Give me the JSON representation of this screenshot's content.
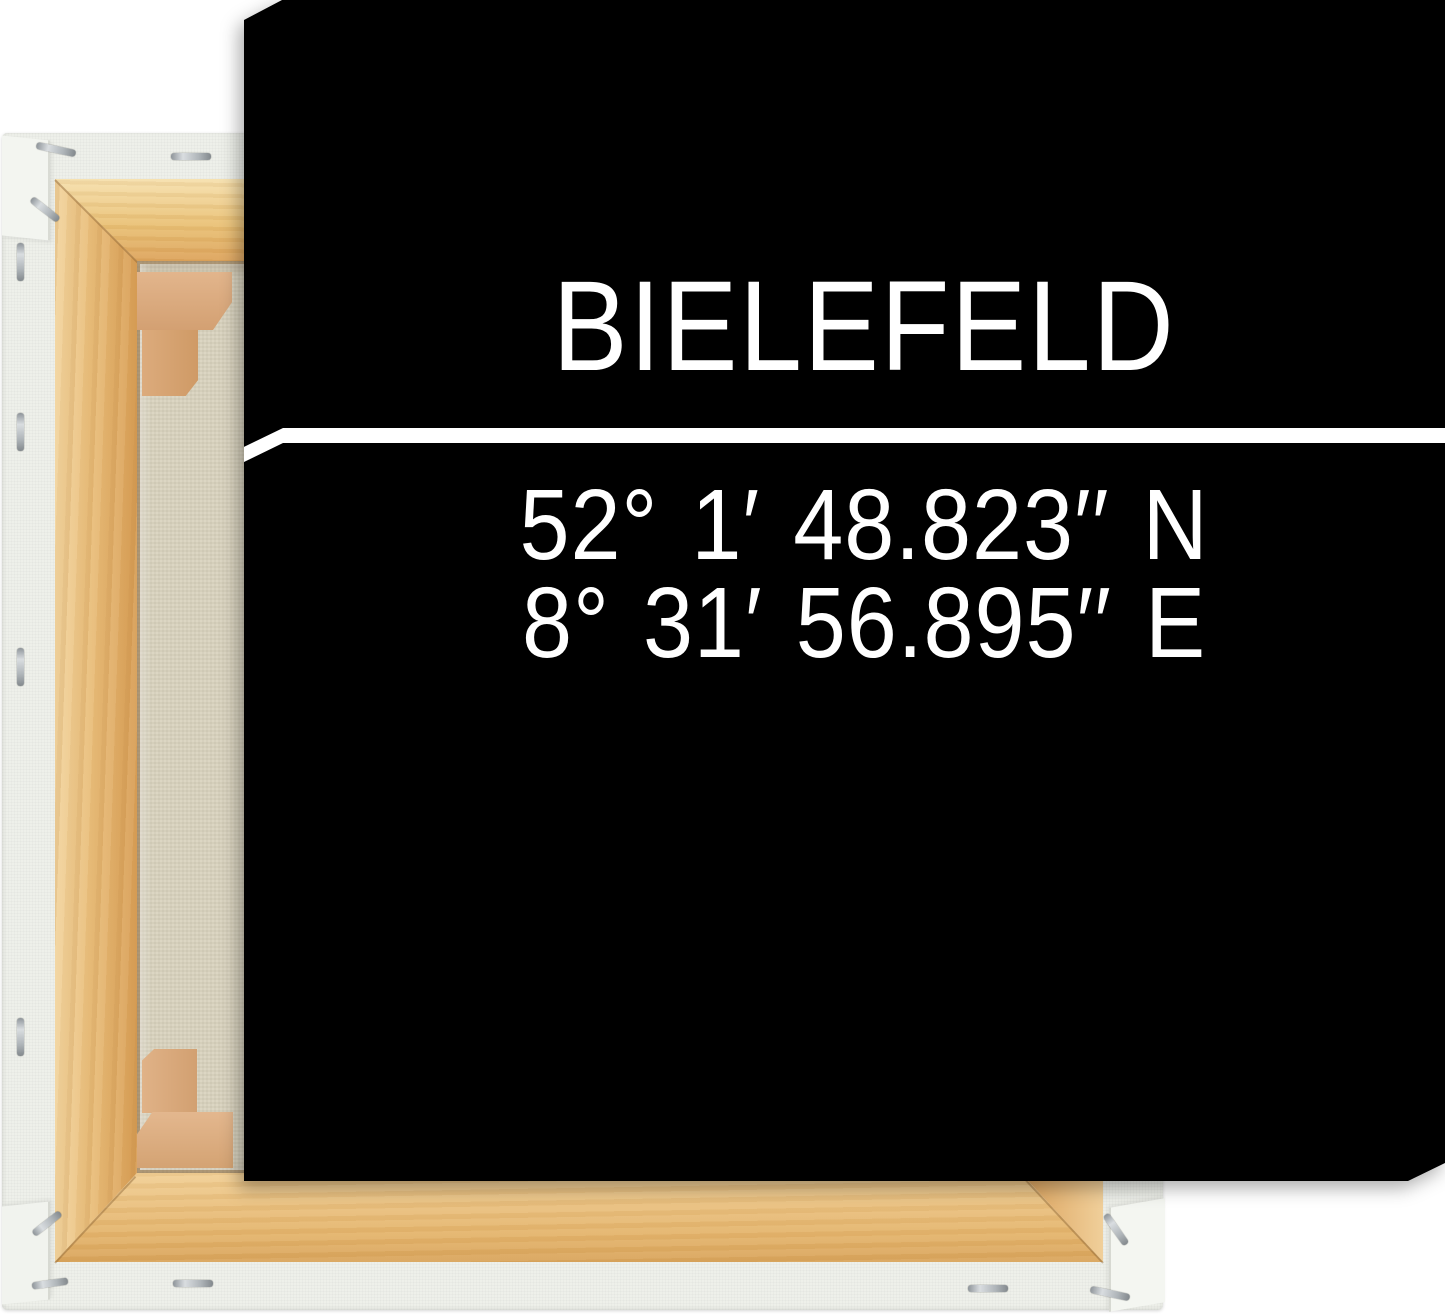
{
  "scene": {
    "background_color": "#ffffff"
  },
  "canvas_print": {
    "title": "BIELEFELD",
    "coordinates": [
      "52° 1′ 48.823′′ N",
      "8° 31′ 56.895′′ E"
    ],
    "background_color": "#000000",
    "text_color": "#ffffff",
    "divider_color": "#ffffff"
  },
  "frame_back": {
    "wrap_color": "#eef0ea",
    "wood_color": "#e9bf79",
    "fabric_color": "#d8d2bd",
    "wedge_color": "#d9a87f",
    "staple_color": "#c6cbce"
  }
}
